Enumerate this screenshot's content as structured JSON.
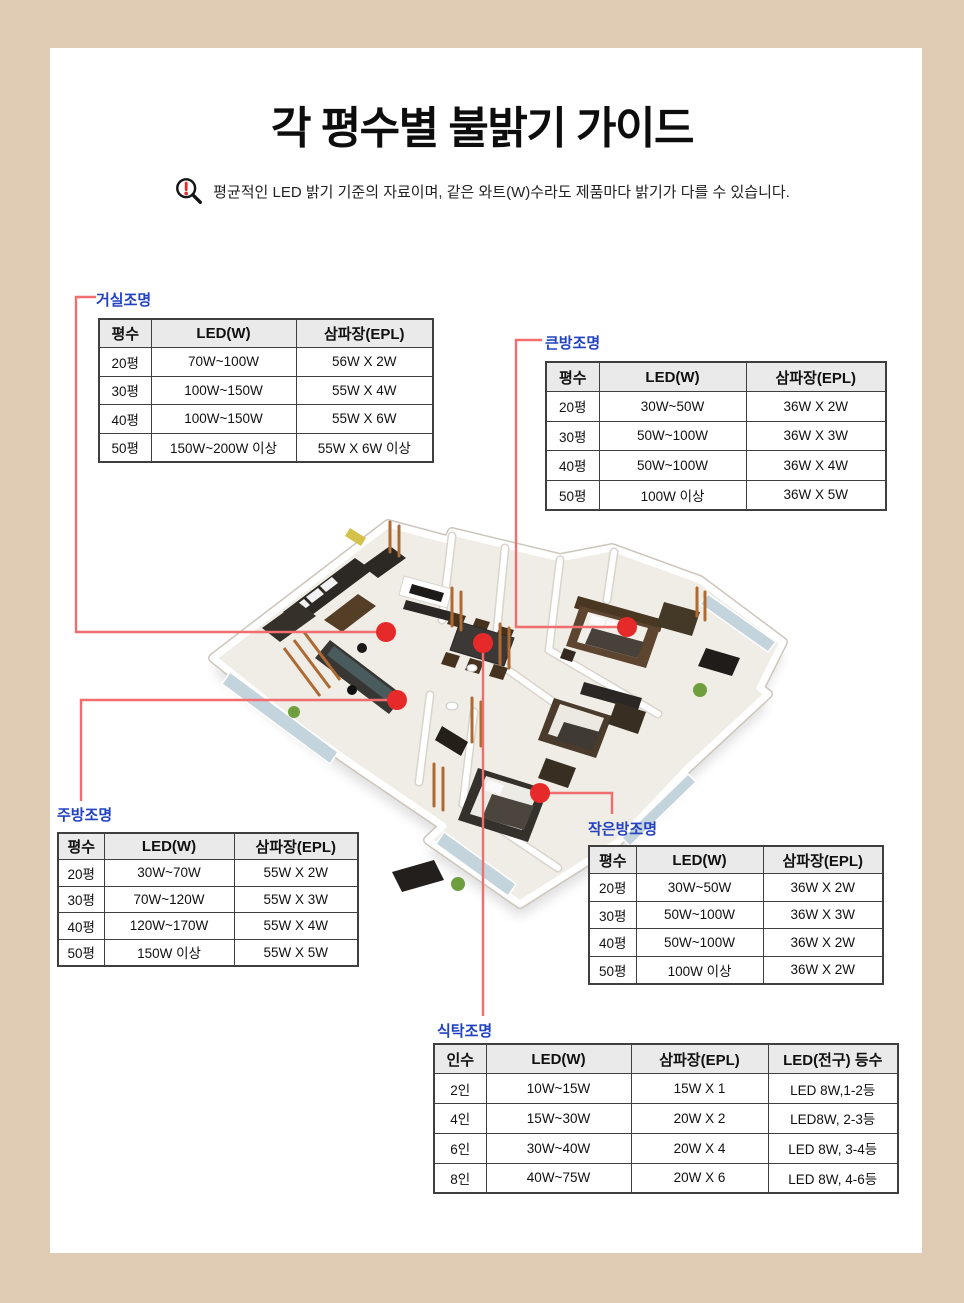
{
  "page": {
    "title": "각 평수별 불밝기 가이드",
    "disclaimer": "평균적인 LED 밝기 기준의 자료이며, 같은 와트(W)수라도 제품마다 밝기가 다를 수 있습니다."
  },
  "colors": {
    "frame_beige": "#e0cbb4",
    "label_blue": "#2342c1",
    "connector_red": "#f26d6d",
    "dot_red": "#e62a2a",
    "table_border": "#3f3f3f",
    "header_bg": "#eaeaea"
  },
  "tables": {
    "living": {
      "label": "거실조명",
      "headers": [
        "평수",
        "LED(W)",
        "삼파장(EPL)"
      ],
      "rows": [
        [
          "20평",
          "70W~100W",
          "56W X 2W"
        ],
        [
          "30평",
          "100W~150W",
          "55W X 4W"
        ],
        [
          "40평",
          "100W~150W",
          "55W X 6W"
        ],
        [
          "50평",
          "150W~200W 이상",
          "55W X 6W 이상"
        ]
      ]
    },
    "bigroom": {
      "label": "큰방조명",
      "headers": [
        "평수",
        "LED(W)",
        "삼파장(EPL)"
      ],
      "rows": [
        [
          "20평",
          "30W~50W",
          "36W X 2W"
        ],
        [
          "30평",
          "50W~100W",
          "36W X 3W"
        ],
        [
          "40평",
          "50W~100W",
          "36W X 4W"
        ],
        [
          "50평",
          "100W 이상",
          "36W X 5W"
        ]
      ]
    },
    "kitchen": {
      "label": "주방조명",
      "headers": [
        "평수",
        "LED(W)",
        "삼파장(EPL)"
      ],
      "rows": [
        [
          "20평",
          "30W~70W",
          "55W X 2W"
        ],
        [
          "30평",
          "70W~120W",
          "55W X 3W"
        ],
        [
          "40평",
          "120W~170W",
          "55W X 4W"
        ],
        [
          "50평",
          "150W 이상",
          "55W X 5W"
        ]
      ]
    },
    "smallroom": {
      "label": "작은방조명",
      "headers": [
        "평수",
        "LED(W)",
        "삼파장(EPL)"
      ],
      "rows": [
        [
          "20평",
          "30W~50W",
          "36W X 2W"
        ],
        [
          "30평",
          "50W~100W",
          "36W X 3W"
        ],
        [
          "40평",
          "50W~100W",
          "36W X 2W"
        ],
        [
          "50평",
          "100W 이상",
          "36W X 2W"
        ]
      ]
    },
    "dining": {
      "label": "식탁조명",
      "headers": [
        "인수",
        "LED(W)",
        "삼파장(EPL)",
        "LED(전구) 등수"
      ],
      "rows": [
        [
          "2인",
          "10W~15W",
          "15W X 1",
          "LED 8W,1-2등"
        ],
        [
          "4인",
          "15W~30W",
          "20W X 2",
          "LED8W, 2-3등"
        ],
        [
          "6인",
          "30W~40W",
          "20W X 4",
          "LED 8W, 3-4등"
        ],
        [
          "8인",
          "40W~75W",
          "20W X 6",
          "LED 8W, 4-6등"
        ]
      ]
    }
  }
}
